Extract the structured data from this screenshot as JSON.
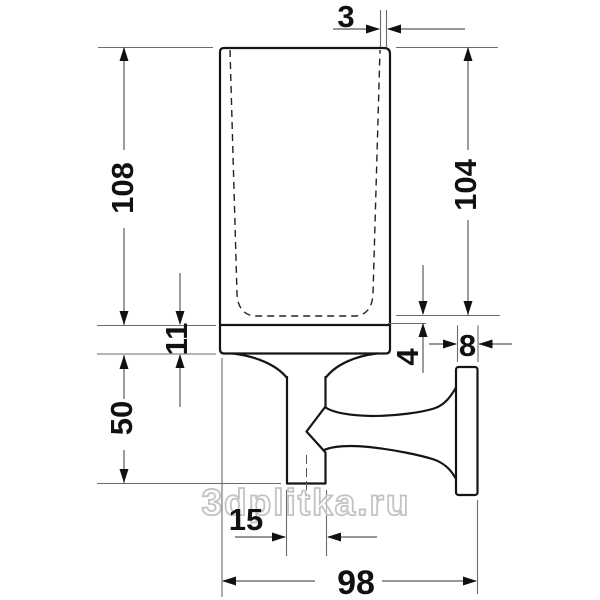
{
  "watermark": "3dplitka.ru",
  "dimensions": {
    "rim_thickness": "3",
    "overall_height": "108",
    "inner_height": "104",
    "holder_band_height": "11",
    "bracket_height": "50",
    "base_thickness": "4",
    "wall_plate_thickness": "8",
    "post_width": "15",
    "overall_depth": "98"
  },
  "colors": {
    "background": "#ffffff",
    "outline": "#151515",
    "dimension_lines": "#595959",
    "labels": "#111111",
    "watermark_outline": "#c3c3c3"
  }
}
